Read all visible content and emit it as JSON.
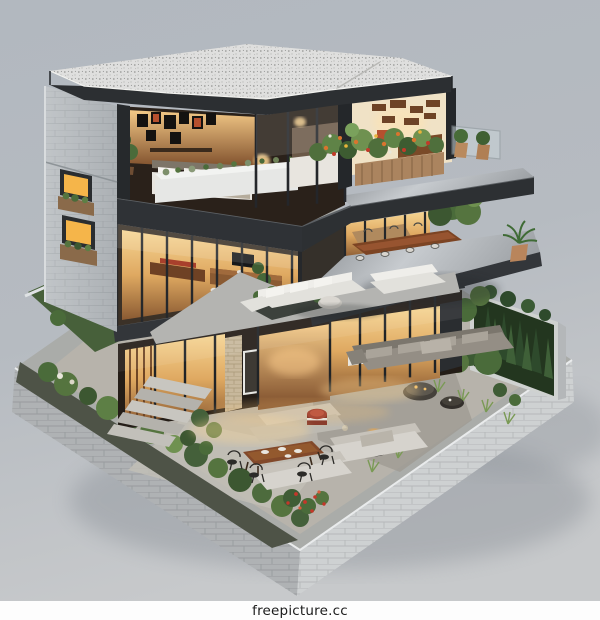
{
  "footer": {
    "text": "freepicture.cc"
  },
  "illustration": {
    "label": "isometric-3d-cutaway-model-of-modern-three-story-house-with-terraces-gardens-and-lit-interiors",
    "palette": {
      "background_top": "#b4bac1",
      "background_bottom": "#c6c8ca",
      "footer_bg": "#fdfdfd",
      "footer_text": "#1b1b1b",
      "roof_gravel": "#e9e9e6",
      "dark_frame": "#2d3033",
      "concrete_wall": "#b7bcc0",
      "base_concrete": "#c3c6c8",
      "warm_light": "#f2bd6b",
      "interior_wood": "#8a5a32",
      "foliage_green": "#55743f",
      "white_furniture": "#e6e5e1",
      "paving_grey": "#b7b3ab"
    }
  }
}
